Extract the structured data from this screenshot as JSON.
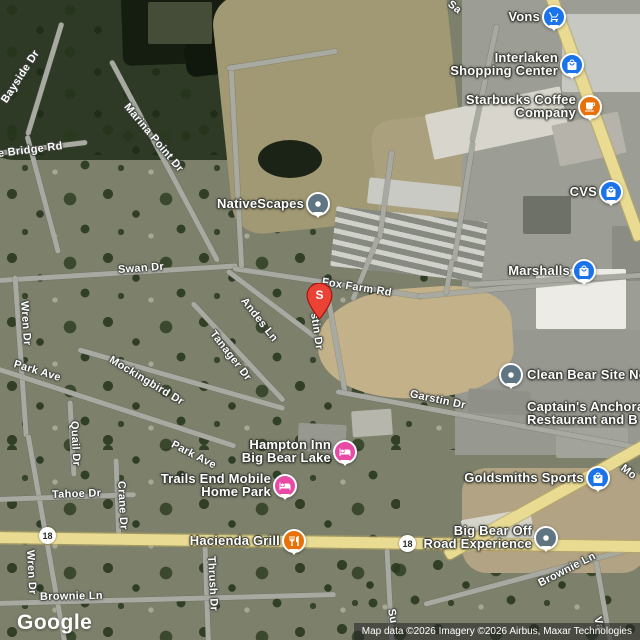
{
  "colors": {
    "poi_blue": "#1a73e8",
    "poi_orange": "#e8710a",
    "poi_pink": "#e84aa5",
    "poi_gray": "#5f7682",
    "search_marker_red": "#EA4335",
    "highway_yellow": "#e9db92",
    "road_gray": "#a8aaa2"
  },
  "map": {
    "google_logo": "Google",
    "attribution": "Map data ©2026 Imagery ©2026 Airbus, Maxar Technologies",
    "search_marker": {
      "letter": "S"
    },
    "highway_shields": [
      {
        "label": "18",
        "x": 39,
        "y": 527
      },
      {
        "label": "18",
        "x": 399,
        "y": 535
      }
    ],
    "road_labels": [
      {
        "text": "Sa",
        "x": 449,
        "y": -3,
        "rot": 38
      },
      {
        "text": "Bayside Dr",
        "x": 4,
        "y": 96,
        "rot": -57
      },
      {
        "text": "Marina Point Dr",
        "x": 126,
        "y": 99,
        "rot": 50
      },
      {
        "text": "e Bridge Rd",
        "x": -2,
        "y": 148,
        "rot": -7
      },
      {
        "text": "Swan Dr",
        "x": 118,
        "y": 264,
        "rot": -4
      },
      {
        "text": "Fox Farm Rd",
        "x": 322,
        "y": 276,
        "rot": 9
      },
      {
        "text": "Wren Dr",
        "x": 24,
        "y": 295,
        "rot": 86
      },
      {
        "text": "Andes Ln",
        "x": 243,
        "y": 293,
        "rot": 52
      },
      {
        "text": "stin Dr",
        "x": 314,
        "y": 307,
        "rot": 82
      },
      {
        "text": "Tanager Dr",
        "x": 212,
        "y": 326,
        "rot": 52
      },
      {
        "text": "Mockingbird Dr",
        "x": 110,
        "y": 353,
        "rot": 31
      },
      {
        "text": "Park Ave",
        "x": 14,
        "y": 358,
        "rot": 17
      },
      {
        "text": "Garstin Dr",
        "x": 410,
        "y": 388,
        "rot": 12
      },
      {
        "text": "Quail Dr",
        "x": 74,
        "y": 415,
        "rot": 87
      },
      {
        "text": "Park Ave",
        "x": 172,
        "y": 438,
        "rot": 27
      },
      {
        "text": "Crane Dr",
        "x": 121,
        "y": 475,
        "rot": 87
      },
      {
        "text": "Tahoe Dr",
        "x": 52,
        "y": 489,
        "rot": -2
      },
      {
        "text": "Wren Dr",
        "x": 30,
        "y": 544,
        "rot": 87
      },
      {
        "text": "Thrush Dr",
        "x": 211,
        "y": 550,
        "rot": 87
      },
      {
        "text": "Brownie Ln",
        "x": 40,
        "y": 591,
        "rot": -1
      },
      {
        "text": "Brownie Ln",
        "x": 539,
        "y": 578,
        "rot": -27
      },
      {
        "text": "Su",
        "x": 391,
        "y": 603,
        "rot": 80
      },
      {
        "text": "Mo",
        "x": 622,
        "y": 461,
        "rot": 38
      },
      {
        "text": "Va",
        "x": 597,
        "y": 611,
        "rot": 75
      }
    ],
    "pois": [
      {
        "id": "vons",
        "lines": [
          "Vons"
        ],
        "icon": "shopping-cart",
        "color": "poi_blue",
        "px": 554,
        "py": 17,
        "align": "right"
      },
      {
        "id": "interlaken-shopping-center",
        "lines": [
          "Interlaken",
          "Shopping Center"
        ],
        "icon": "shopping-bag",
        "color": "poi_blue",
        "px": 572,
        "py": 65,
        "align": "right"
      },
      {
        "id": "starbucks-coffee-company",
        "lines": [
          "Starbucks Coffee",
          "Company"
        ],
        "icon": "coffee-cup",
        "color": "poi_orange",
        "px": 590,
        "py": 107,
        "align": "right"
      },
      {
        "id": "cvs",
        "lines": [
          "CVS"
        ],
        "icon": "shopping-bag",
        "color": "poi_blue",
        "px": 611,
        "py": 192,
        "align": "right"
      },
      {
        "id": "nativescapes",
        "lines": [
          "NativeScapes"
        ],
        "icon": "dot",
        "color": "poi_gray",
        "px": 318,
        "py": 204,
        "align": "right"
      },
      {
        "id": "marshalls",
        "lines": [
          "Marshalls"
        ],
        "icon": "shopping-bag",
        "color": "poi_blue",
        "px": 584,
        "py": 271,
        "align": "right"
      },
      {
        "id": "clean-bear-site",
        "lines": [
          "Clean Bear Site No"
        ],
        "icon": "dot",
        "color": "poi_gray",
        "px": 511,
        "py": 375,
        "align": "left"
      },
      {
        "id": "captains-anchorage",
        "lines": [
          "Captain's Anchora",
          "Restaurant and B"
        ],
        "icon": "none",
        "color": "poi_gray",
        "px": 527,
        "py": 414,
        "align": "left"
      },
      {
        "id": "hampton-inn-big-bear-lake",
        "lines": [
          "Hampton Inn",
          "Big Bear Lake"
        ],
        "icon": "bed",
        "color": "poi_pink",
        "px": 345,
        "py": 452,
        "align": "right"
      },
      {
        "id": "goldsmiths-sports",
        "lines": [
          "Goldsmiths Sports"
        ],
        "icon": "shopping-bag",
        "color": "poi_blue",
        "px": 598,
        "py": 478,
        "align": "right"
      },
      {
        "id": "trails-end-mobile-home-park",
        "lines": [
          "Trails End Mobile",
          "Home Park"
        ],
        "icon": "bed",
        "color": "poi_pink",
        "px": 285,
        "py": 486,
        "align": "right"
      },
      {
        "id": "hacienda-grill",
        "lines": [
          "Hacienda Grill"
        ],
        "icon": "restaurant",
        "color": "poi_orange",
        "px": 294,
        "py": 541,
        "align": "right"
      },
      {
        "id": "big-bear-off-road-experience",
        "lines": [
          "Big Bear Off",
          "Road Experience"
        ],
        "icon": "dot",
        "color": "poi_gray",
        "px": 546,
        "py": 538,
        "align": "right"
      }
    ]
  }
}
